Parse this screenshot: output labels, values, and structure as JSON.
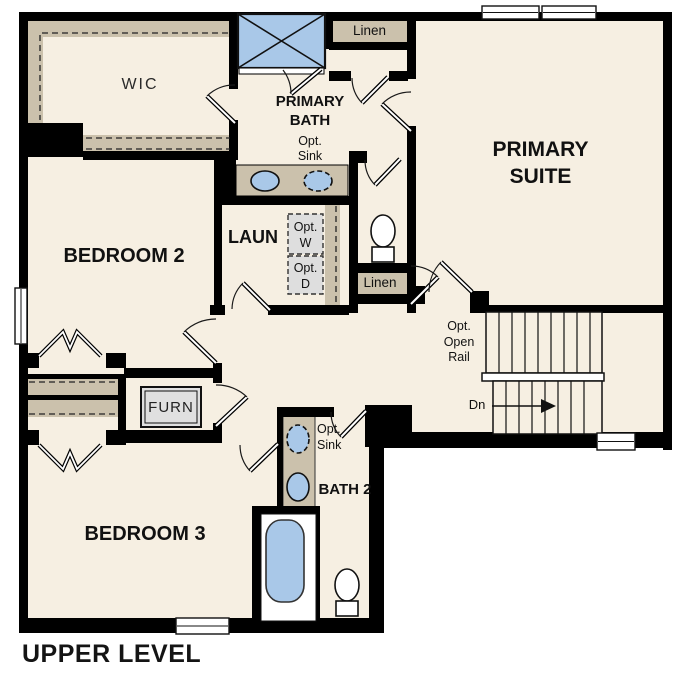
{
  "plan": {
    "level_label": "UPPER LEVEL"
  },
  "colors": {
    "wall": "#000000",
    "floor": "#f6efe2",
    "cabinet_tan": "#cbc1ac",
    "fixture_blue": "#a9c8e8",
    "appliance_gray": "#dedede"
  },
  "rooms": {
    "wic": {
      "label": "WIC"
    },
    "primary_bath": {
      "label": "PRIMARY BATH",
      "opt_sink_label": "Opt. Sink"
    },
    "linen_top": {
      "label": "Linen"
    },
    "primary_suite": {
      "label": "PRIMARY SUITE"
    },
    "bedroom2": {
      "label": "BEDROOM 2"
    },
    "laundry": {
      "label": "LAUN",
      "opt_washer_label": "Opt. W",
      "opt_dryer_label": "Opt. D"
    },
    "linen_hall": {
      "label": "Linen"
    },
    "stairs": {
      "rail_label": "Opt. Open Rail",
      "down_label": "Dn"
    },
    "furnace": {
      "label": "FURN"
    },
    "bedroom3": {
      "label": "BEDROOM 3"
    },
    "bath2": {
      "label": "BATH 2",
      "opt_sink_label": "Opt. Sink"
    }
  }
}
